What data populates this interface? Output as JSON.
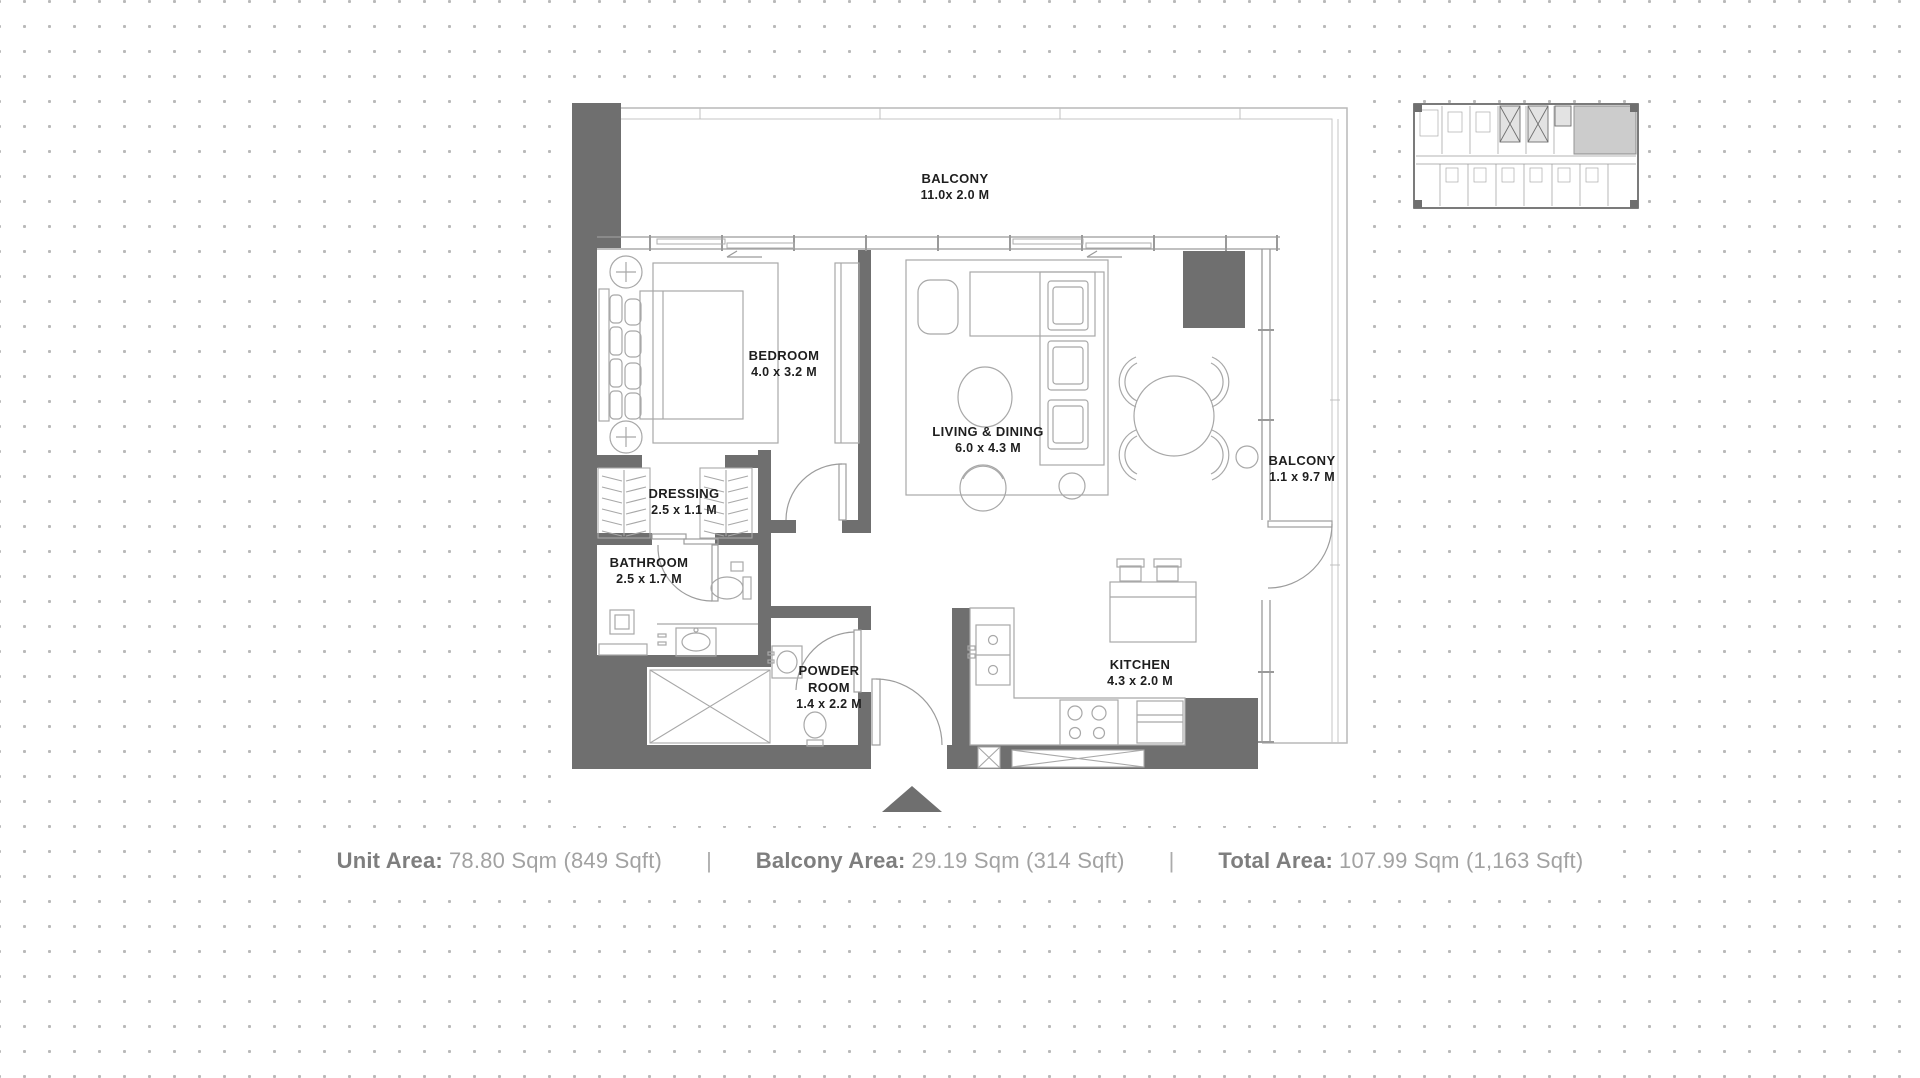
{
  "plan": {
    "rooms": [
      {
        "name": "BALCONY",
        "dims": "11.0x 2.0 M"
      },
      {
        "name": "BEDROOM",
        "dims": "4.0 x 3.2 M"
      },
      {
        "name": "LIVING & DINING",
        "dims": "6.0 x 4.3 M"
      },
      {
        "name": "BALCONY",
        "dims": "1.1 x 9.7 M"
      },
      {
        "name": "DRESSING",
        "dims": "2.5 x 1.1 M"
      },
      {
        "name": "BATHROOM",
        "dims": "2.5 x 1.7 M"
      },
      {
        "name": "POWDER ROOM",
        "dims": "1.4 x 2.2 M"
      },
      {
        "name": "KITCHEN",
        "dims": "4.3 x 2.0 M"
      }
    ],
    "colors": {
      "wall": "#6f6f6f",
      "furniture_line": "#a8a8a8",
      "label_text": "#1e1e1e",
      "balcony_outline": "#b9b9b9",
      "key_plan_highlight": "#cccccc",
      "summary_label": "#7e7e7e",
      "summary_value": "#a2a2a2"
    }
  },
  "summary": {
    "separator": "|",
    "segments": [
      {
        "label": "Unit Area:",
        "value": "78.80 Sqm (849 Sqft)"
      },
      {
        "label": "Balcony Area:",
        "value": "29.19 Sqm (314 Sqft)"
      },
      {
        "label": "Total Area:",
        "value": "107.99 Sqm (1,163 Sqft)"
      }
    ]
  }
}
